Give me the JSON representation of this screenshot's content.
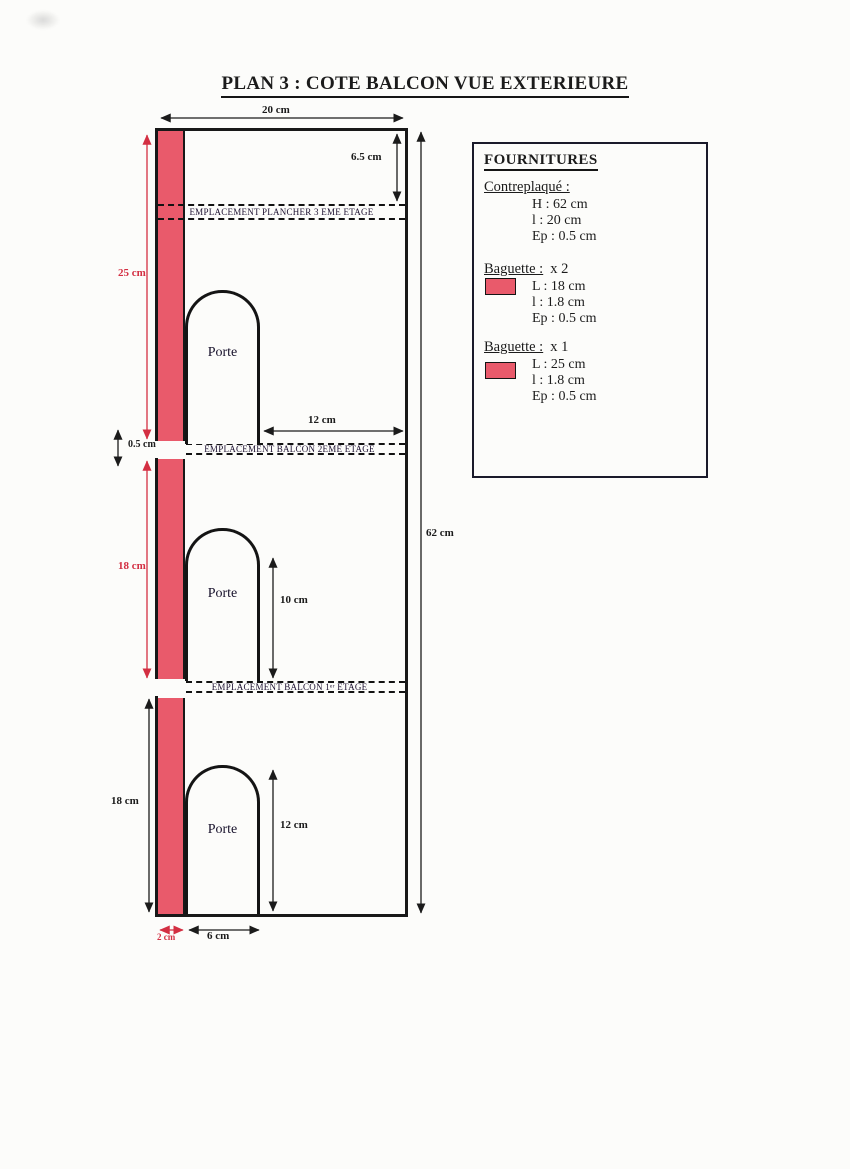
{
  "page": {
    "title": "PLAN 3 : COTE BALCON VUE EXTERIEURE"
  },
  "drawing": {
    "door_labels": [
      "Porte",
      "Porte",
      "Porte"
    ],
    "bands": [
      {
        "label": "EMPLACEMENT PLANCHER 3 EME ETAGE"
      },
      {
        "label": "EMPLACEMENT BALCON 2EME ETAGE"
      },
      {
        "label": "EMPLACEMENT BALCON 1ᵉʳ ETAGE"
      }
    ],
    "dimensions": {
      "top_width": "20 cm",
      "plancher_offset": "6.5 cm",
      "total_height": "62 cm",
      "left_top_baguette": "25 cm",
      "balcony_thickness": "0.5 cm",
      "left_mid_baguette": "18 cm",
      "left_bottom_section": "18 cm",
      "door1_to_wall": "12 cm",
      "door2_height": "10 cm",
      "door3_height": "12 cm",
      "baguette_width": "2 cm",
      "door_width": "6 cm"
    }
  },
  "fournitures": {
    "title": "FOURNITURES",
    "sections": [
      {
        "heading": "Contreplaqué :",
        "qty": "",
        "lines": [
          "H : 62 cm",
          "l : 20 cm",
          "Ep : 0.5 cm"
        ]
      },
      {
        "heading": "Baguette :",
        "qty": "x 2",
        "lines": [
          "L : 18 cm",
          "l : 1.8 cm",
          "Ep : 0.5 cm"
        ]
      },
      {
        "heading": "Baguette :",
        "qty": "x 1",
        "lines": [
          "L : 25 cm",
          "l : 1.8 cm",
          "Ep : 0.5 cm"
        ]
      }
    ]
  },
  "colors": {
    "baguette_red": "#e95a6b",
    "dim_red": "#d32f42",
    "line_black": "#1b1b1b"
  }
}
